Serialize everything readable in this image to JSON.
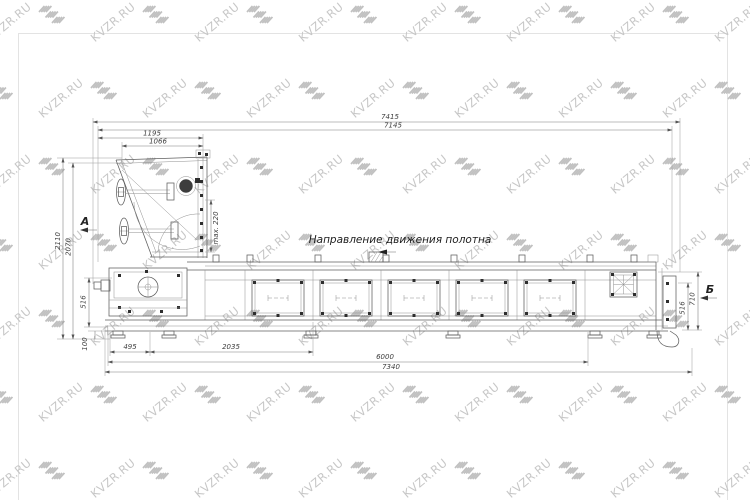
{
  "watermark": {
    "text": "KVZR.RU",
    "text_color": "#c7c7c7",
    "logo_color": "#c1c1c1"
  },
  "page": {
    "background": "#ffffff",
    "border_color": "#e3e3e3"
  },
  "drawing": {
    "direction_label": "Направление движения полотна",
    "view_labels": {
      "a": "А",
      "b": "Б"
    },
    "dims": {
      "total_length": "7415",
      "upper_length": "7145",
      "hopper_width_outer": "1195",
      "hopper_width_inner": "1066",
      "height_overall": "2110",
      "height_body": "2070",
      "max_gap": "max. 220",
      "left_small_height": "516",
      "foot_height": "100",
      "drive_offset": "495",
      "first_section": "2035",
      "conveyor_length": "6000",
      "base_length": "7340",
      "right_small_height": "516",
      "right_height": "710"
    }
  }
}
